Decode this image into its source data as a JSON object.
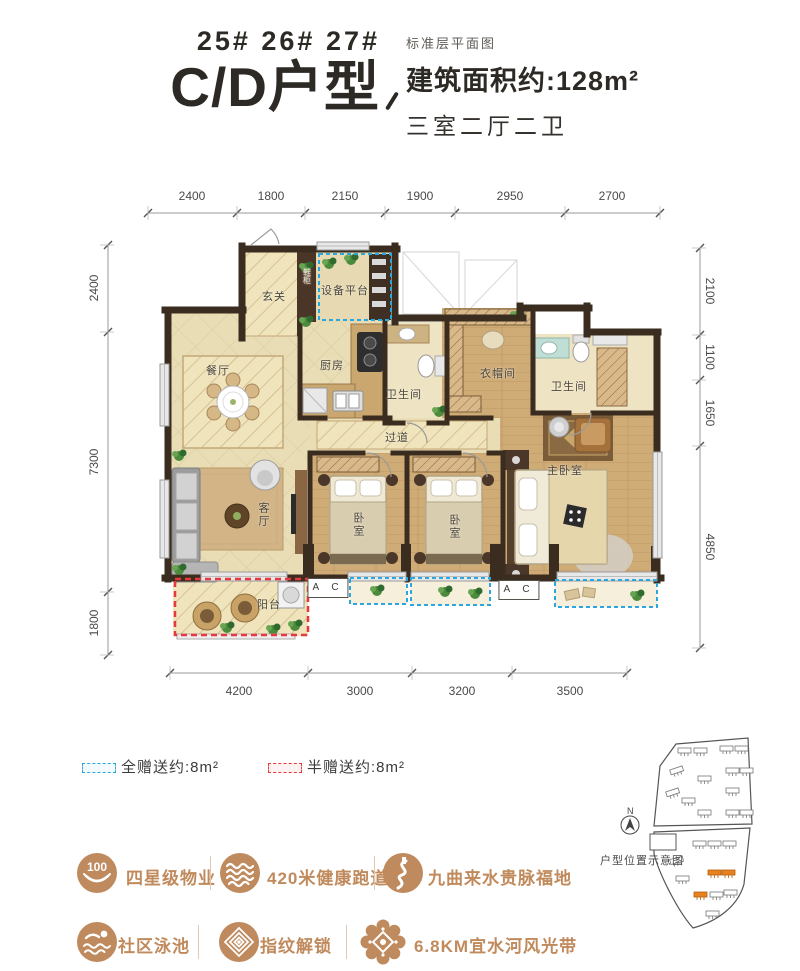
{
  "header": {
    "buildings": "25# 26# 27#",
    "title": "C/D户型",
    "floor_note": "标准层平面图",
    "area": "建筑面积约:128m²",
    "rooms_summary": "三室二厅二卫"
  },
  "dimensions": {
    "top": [
      "2400",
      "1800",
      "2150",
      "1900",
      "2950",
      "2700"
    ],
    "left": [
      "2400",
      "7300",
      "1800"
    ],
    "right": [
      "2100",
      "1100",
      "1650",
      "4850"
    ],
    "bottom": [
      "4200",
      "3000",
      "3200",
      "3500"
    ]
  },
  "plan": {
    "rooms": {
      "entry": "玄关",
      "shoe_cabinet": "鞋柜",
      "equipment_platform": "设备平台",
      "dining": "餐厅",
      "kitchen": "厨房",
      "bath1": "卫生间",
      "cloakroom": "衣帽间",
      "bath2": "卫生间",
      "hallway": "过道",
      "living": "客厅",
      "bedroom1": "卧室",
      "bedroom2": "卧室",
      "master_bedroom": "主卧室",
      "balcony": "阳台"
    },
    "ac_label": "A C"
  },
  "legend": {
    "full_gift": "全赠送约:8m²",
    "half_gift": "半赠送约:8m²"
  },
  "features": [
    {
      "icon": "property-rating-icon",
      "badge": "100",
      "label": "四星级物业"
    },
    {
      "icon": "running-track-icon",
      "label": "420米健康跑道"
    },
    {
      "icon": "winding-river-icon",
      "label": "九曲来水贵脉福地"
    },
    {
      "icon": "swimming-pool-icon",
      "label": "社区泳池"
    },
    {
      "icon": "fingerprint-lock-icon",
      "label": "指纹解锁"
    },
    {
      "icon": "scenic-belt-icon",
      "label": "6.8KM宜水河风光带"
    }
  ],
  "site_map": {
    "north_label": "N",
    "caption": "户型位置示意图"
  },
  "colors": {
    "accent_bronze": "#bf8a5e",
    "gift_full_blue": "#2aa7df",
    "gift_half_red": "#e8383d",
    "wall_dark": "#3a2d20"
  }
}
